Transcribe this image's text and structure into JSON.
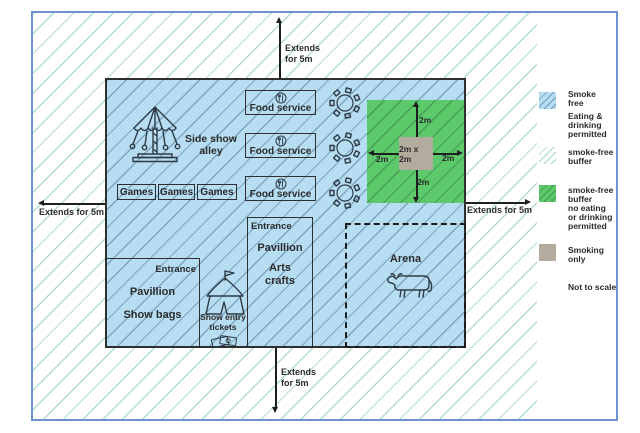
{
  "colors": {
    "smoke_free_fill": "#b6ddf1",
    "buffer_line": "#8ccdaa",
    "buffer_green_fill": "#5cc96b",
    "smoking_only_fill": "#b2ab9e",
    "frame_border": "#6e92d0",
    "outline": "#2f2f2f"
  },
  "arrows": {
    "top": "Extends\nfor 5m",
    "bottom": "Extends\nfor 5m",
    "left": "Extends for 5m",
    "right": "Extends for 5m"
  },
  "venue": {
    "side_show_alley": "Side show\nalley",
    "games": [
      "Games",
      "Games",
      "Games"
    ],
    "food_service": [
      "Food service",
      "Food service",
      "Food service"
    ],
    "show_bags": {
      "entrance": "Entrance",
      "title": "Pavillion",
      "subtitle": "Show bags"
    },
    "arts_crafts": {
      "entrance": "Entrance",
      "title": "Pavillion",
      "subtitle": "Arts\ncrafts"
    },
    "show_entry_tickets": "Show entry\ntickets",
    "arena": "Arena"
  },
  "smoking_area": {
    "top": "2m",
    "bottom": "2m",
    "left": "2m",
    "right": "2m",
    "center": "2m x 2m"
  },
  "legend": {
    "smoke_free": {
      "label": "Smoke\nfree",
      "sublabel": "Eating &\ndrinking\npermitted",
      "color": "#b6ddf1"
    },
    "smoke_free_buffer": {
      "label": "smoke-free\nbuffer",
      "color": "#ffffff"
    },
    "buffer_no_eating": {
      "label": "smoke-free\nbuffer\nno eating\nor drinking\npermitted",
      "color": "#5cc96b"
    },
    "smoking_only": {
      "label": "Smoking\nonly",
      "color": "#b2ab9e"
    },
    "note": "Not to scale"
  },
  "icons": {
    "carousel": "carousel-icon",
    "food_service": "cutlery-plate-icon",
    "table": "picnic-table-icon",
    "tent": "circus-tent-icon",
    "tickets": "tickets-icon",
    "cow": "cow-icon"
  }
}
